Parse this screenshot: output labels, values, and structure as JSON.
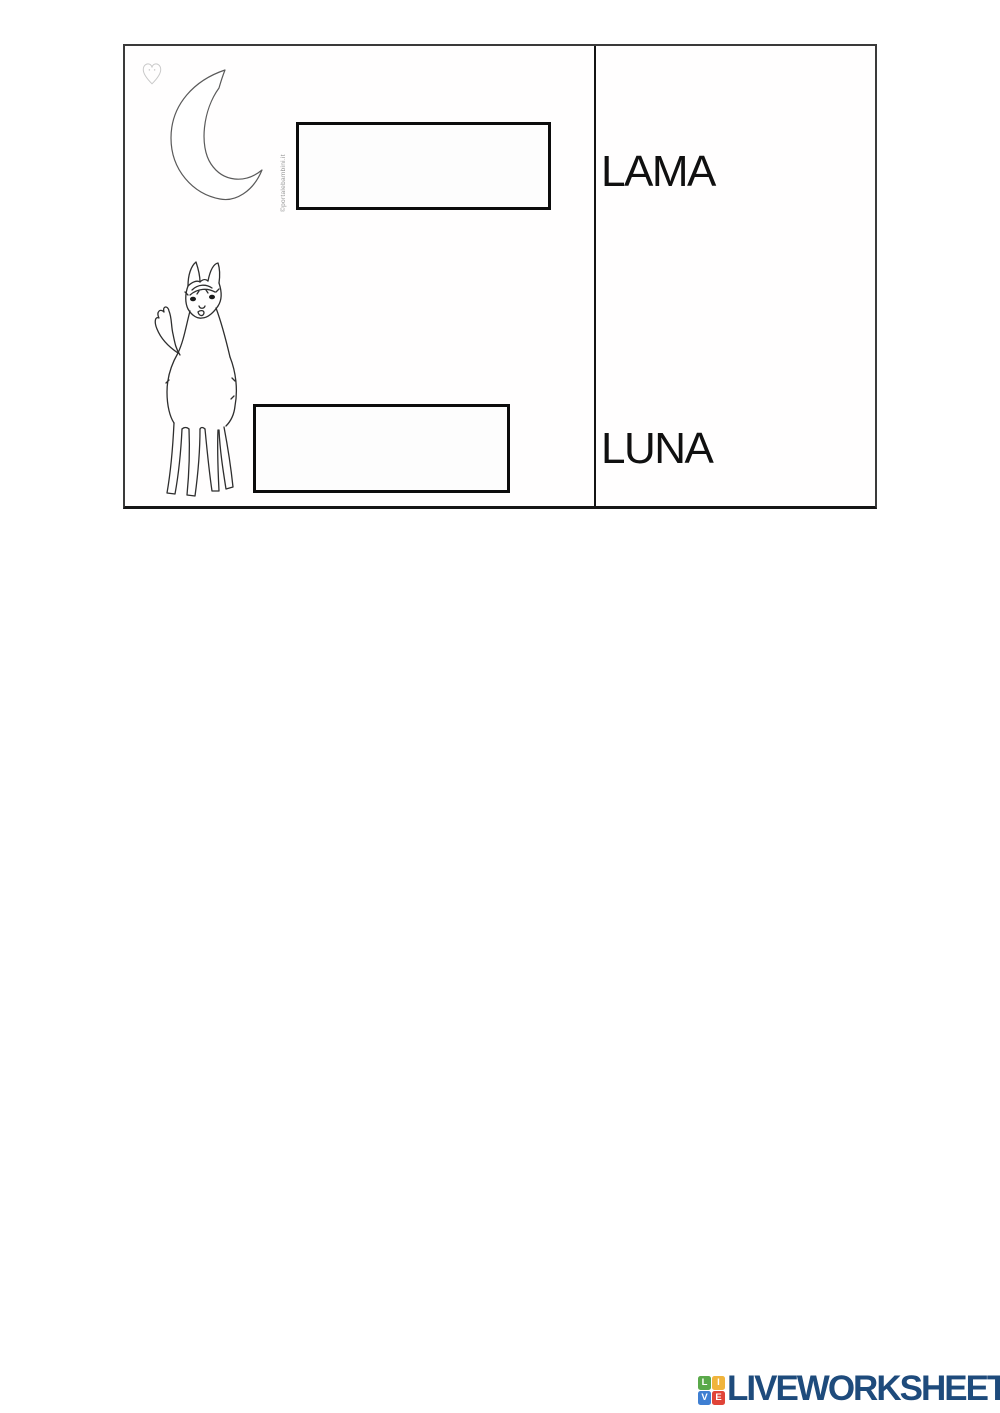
{
  "worksheet": {
    "left": {
      "watermark_text": "©portalebambini.it",
      "answer_boxes": [
        {
          "for": "moon",
          "value": "",
          "placeholder": ""
        },
        {
          "for": "llama",
          "value": "",
          "placeholder": ""
        }
      ]
    },
    "right": {
      "words": [
        {
          "label": "LAMA"
        },
        {
          "label": "LUNA"
        }
      ]
    }
  },
  "footer": {
    "brand": "LIVEWORKSHEETS",
    "brand_color": "#1e4b7c",
    "logo_squares": [
      {
        "letter": "L",
        "color": "#5aa94a"
      },
      {
        "letter": "I",
        "color": "#f0b43c"
      },
      {
        "letter": "V",
        "color": "#3f7fd2"
      },
      {
        "letter": "E",
        "color": "#e04438"
      }
    ]
  }
}
